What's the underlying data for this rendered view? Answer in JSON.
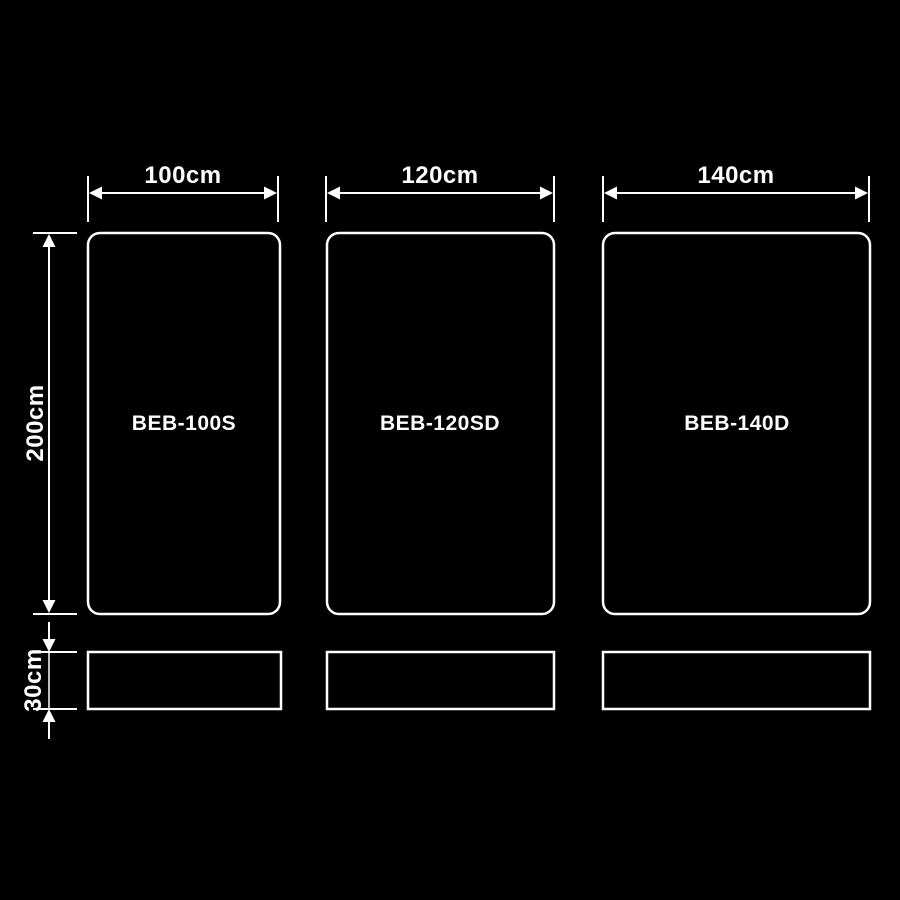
{
  "diagram": {
    "background_color": "#000000",
    "line_color": "#ffffff",
    "text_color": "#ffffff",
    "products": [
      {
        "model": "BEB-100S",
        "width_label": "100cm",
        "width_cm": 100
      },
      {
        "model": "BEB-120SD",
        "width_label": "120cm",
        "width_cm": 120
      },
      {
        "model": "BEB-140D",
        "width_label": "140cm",
        "width_cm": 140
      }
    ],
    "height_label": "200cm",
    "height_cm": 200,
    "base_height_label": "30cm",
    "base_height_cm": 30
  }
}
